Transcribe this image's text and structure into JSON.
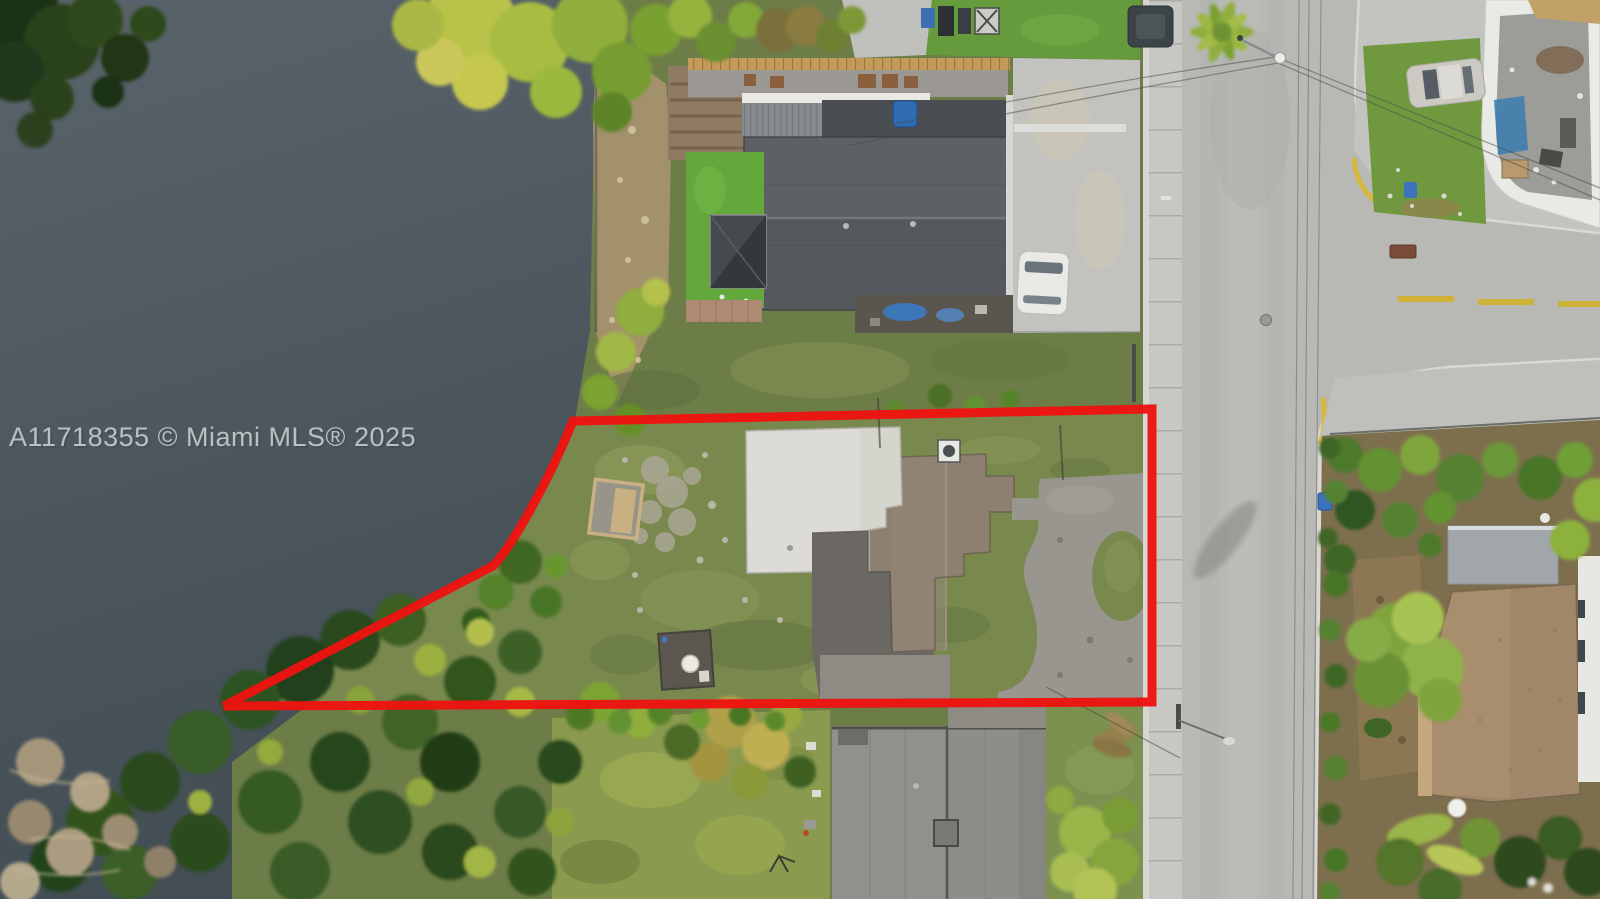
{
  "image": {
    "watermark": "A11718355 © Miami MLS® 2025",
    "kind": "aerial-drone-photo",
    "subject": "waterfront-lot-with-red-property-boundary"
  },
  "colors": {
    "boundary_red": "#ee1310",
    "water": "#4a555c",
    "road": "#b8b9b5",
    "sidewalk": "#c7c8c4",
    "lot_grass": "#79894e",
    "flat_roof_white": "#dcdbd5",
    "shingle_roof_brown": "#8d8071",
    "top_house_roof_gray": "#55585c",
    "bottom_house_roof_gray": "#8f8d88",
    "se_house_roof_tan": "#a1876a",
    "se_shed_roof": "#a0a6aa",
    "centerline_yellow": "#d0b238",
    "watermark_gray": "#d8dadc"
  },
  "objects": {
    "vehicles": [
      {
        "name": "white-sedan-top-parking",
        "color": "#e9eae6"
      },
      {
        "name": "silver-sedan-northeast",
        "color": "#ccc9c2"
      },
      {
        "name": "dark-suv-road-top",
        "color": "#3d4448"
      }
    ],
    "bins": [
      {
        "name": "blue-bin-bottom",
        "color": "#3a74c2"
      },
      {
        "name": "green-bin-bottom",
        "color": "#48823c"
      },
      {
        "name": "blue-bin-east-curb",
        "color": "#3a72bf"
      }
    ]
  }
}
